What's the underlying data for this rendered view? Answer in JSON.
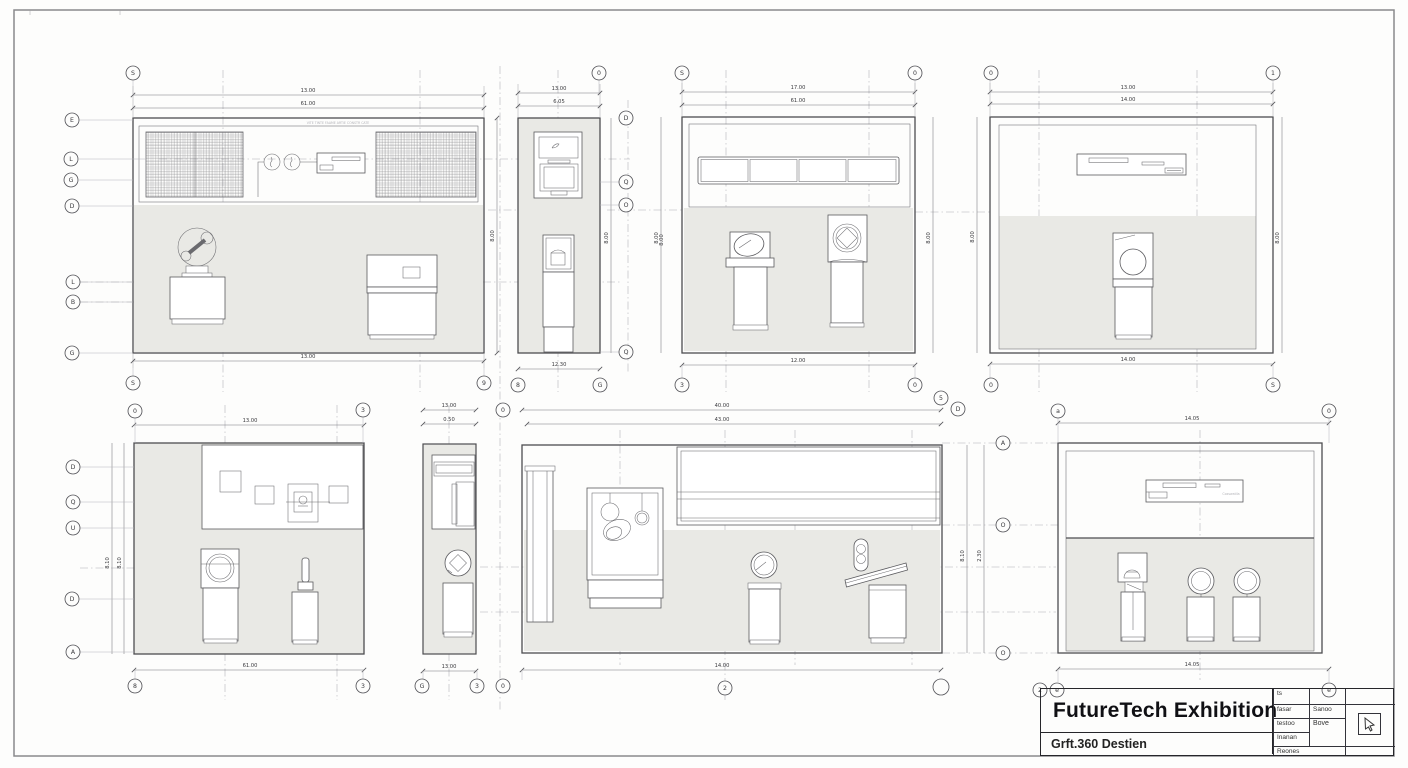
{
  "sheet": {
    "paper_color": "#fdfdfc",
    "line_color": "#4d4d50",
    "gray_fill": "#e9e9e5"
  },
  "title_block": {
    "title": "FutureTech Exhibition",
    "subtitle": "Grft.360 Destien",
    "table": {
      "r1c1": "ts",
      "r2c1": "fasar",
      "r2c2": "Sanoo",
      "r3c1": "testoo",
      "r3c2": "Bove",
      "r4c1": "Inanan",
      "r5c1": "Reones"
    },
    "stamp_icon": "cursor-icon"
  },
  "panels": {
    "p1": {
      "dim_top1": "13.00",
      "dim_top2": "61.00",
      "dim_bottom": "13.00",
      "dim_right": "8.00",
      "note": "VITE TINTE FAAME   ARTIE   CONSTR CATE",
      "bubbles": {
        "top": "S",
        "bottom_left": "S",
        "bottom_right": "9",
        "left": [
          "E",
          "L",
          "G",
          "D",
          "L",
          "B",
          "G"
        ]
      }
    },
    "p2": {
      "dim_top1": "13.00",
      "dim_top2": "6.05",
      "dim_bottom": "12.30",
      "dim_left": "8.00",
      "dim_right": "8.00",
      "bubbles": {
        "top": "0",
        "bottom_left": "8",
        "bottom_right": "G",
        "right": [
          "D",
          "Q",
          "O",
          "Q"
        ]
      }
    },
    "p3": {
      "dim_top1": "17.00",
      "dim_top2": "61.00",
      "dim_bottom": "12.00",
      "dim_left": "8.00",
      "dim_right": "8.00",
      "bubbles": {
        "top_left": "S",
        "top_right": "0",
        "bottom_left": "3",
        "bottom_right": "0"
      }
    },
    "p4": {
      "dim_top1": "13.00",
      "dim_top2": "14.00",
      "dim_bottom": "14.00",
      "dim_left": "8.00",
      "dim_right": "8.00",
      "bubbles": {
        "top_left": "0",
        "top_right": "1",
        "bottom_left": "0",
        "bottom_right": "S"
      }
    },
    "p5": {
      "dim_top": "13.00",
      "dim_bottom": "61.00",
      "dim_left1": "8.10",
      "dim_left2": "8.10",
      "bubbles": {
        "top_left": "0",
        "top_right": "3",
        "bottom_left": "8",
        "bottom_right": "3",
        "left": [
          "D",
          "Q",
          "U",
          "D",
          "A"
        ]
      }
    },
    "p6": {
      "dim_top1": "13.00",
      "dim_top2": "0.50",
      "dim_bottom": "13.00",
      "bubbles": {
        "top": "0",
        "bottom": [
          "G",
          "3",
          "0"
        ]
      }
    },
    "p7": {
      "dim_top1": "40.00",
      "dim_top2": "43.00",
      "dim_bottom": "14.00",
      "dim_right1": "8.10",
      "dim_right2": "2.30",
      "bubbles": {
        "top1": "5",
        "top2": "D",
        "bottom": "2",
        "bottom_right": "",
        "right": [
          "A",
          "O",
          "O"
        ]
      }
    },
    "p8": {
      "dim_top": "14.05",
      "dim_bottom": "14.05",
      "sign_note": "Coxswatila",
      "bubbles": {
        "top_left": "a",
        "top_right": "0",
        "bottom1": "2",
        "bottom2": "e",
        "bottom3": "e"
      }
    }
  }
}
